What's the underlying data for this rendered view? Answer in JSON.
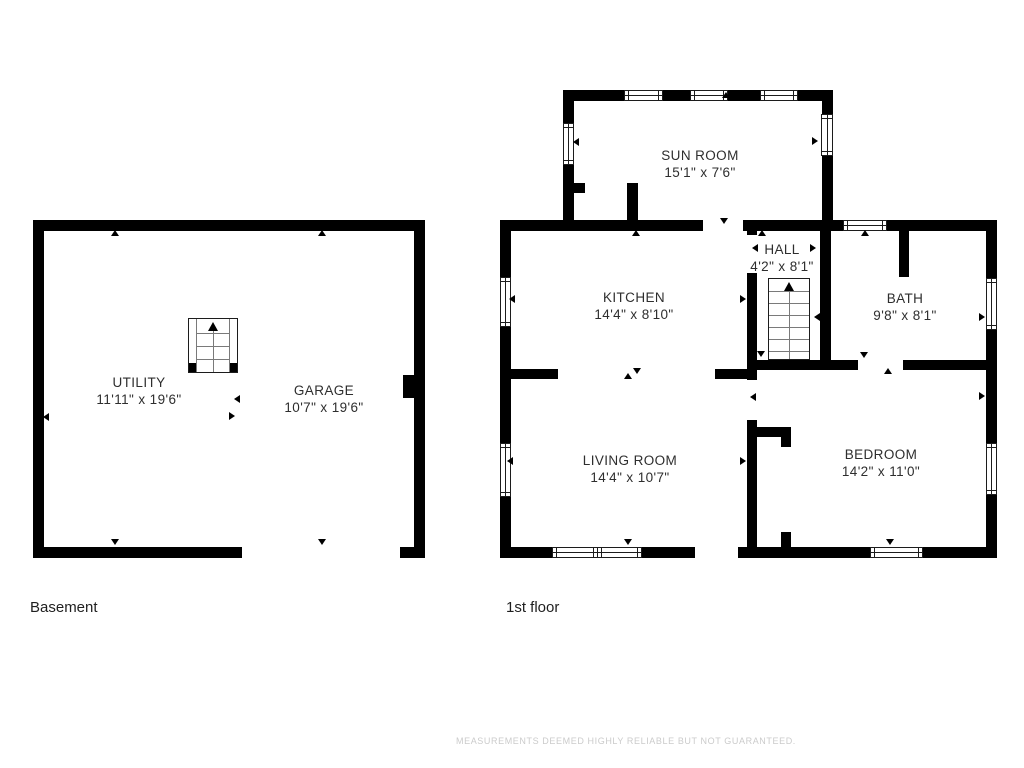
{
  "page": {
    "footer": "MEASUREMENTS DEEMED HIGHLY RELIABLE BUT NOT GUARANTEED."
  },
  "colors": {
    "wall": "#000000",
    "text": "#2e2e2e"
  },
  "floors": [
    {
      "id": "basement",
      "caption": "Basement",
      "caption_pos": {
        "x": 30,
        "y": 599
      },
      "rooms": [
        {
          "name": "UTILITY",
          "dims": "11'11\" x 19'6\"",
          "cx": 139,
          "cy": 374
        },
        {
          "name": "GARAGE",
          "dims": "10'7\" x 19'6\"",
          "cx": 324,
          "cy": 382
        }
      ]
    },
    {
      "id": "first-floor",
      "caption": "1st floor",
      "caption_pos": {
        "x": 506,
        "y": 599
      },
      "rooms": [
        {
          "name": "SUN ROOM",
          "dims": "15'1\" x 7'6\"",
          "cx": 700,
          "cy": 147
        },
        {
          "name": "KITCHEN",
          "dims": "14'4\" x 8'10\"",
          "cx": 634,
          "cy": 289
        },
        {
          "name": "HALL",
          "dims": "4'2\" x 8'1\"",
          "cx": 782,
          "cy": 241
        },
        {
          "name": "BATH",
          "dims": "9'8\" x 8'1\"",
          "cx": 905,
          "cy": 290
        },
        {
          "name": "LIVING ROOM",
          "dims": "14'4\" x 10'7\"",
          "cx": 630,
          "cy": 452
        },
        {
          "name": "BEDROOM",
          "dims": "14'2\" x 11'0\"",
          "cx": 881,
          "cy": 446
        }
      ]
    }
  ],
  "geometry": {
    "walls": [
      {
        "x": 33,
        "y": 220,
        "w": 392,
        "h": 11
      },
      {
        "x": 33,
        "y": 220,
        "w": 11,
        "h": 338
      },
      {
        "x": 414,
        "y": 220,
        "w": 11,
        "h": 338
      },
      {
        "x": 33,
        "y": 547,
        "w": 392,
        "h": 11
      },
      {
        "x": 500,
        "y": 220,
        "w": 497,
        "h": 11
      },
      {
        "x": 500,
        "y": 220,
        "w": 11,
        "h": 338
      },
      {
        "x": 986,
        "y": 220,
        "w": 11,
        "h": 338
      },
      {
        "x": 500,
        "y": 547,
        "w": 497,
        "h": 11
      },
      {
        "x": 563,
        "y": 90,
        "w": 270,
        "h": 11
      },
      {
        "x": 563,
        "y": 90,
        "w": 11,
        "h": 141
      },
      {
        "x": 822,
        "y": 90,
        "w": 11,
        "h": 141
      },
      {
        "x": 563,
        "y": 183,
        "w": 75,
        "h": 10
      },
      {
        "x": 627,
        "y": 183,
        "w": 11,
        "h": 48
      },
      {
        "x": 747,
        "y": 220,
        "w": 10,
        "h": 148
      },
      {
        "x": 820,
        "y": 220,
        "w": 11,
        "h": 150
      },
      {
        "x": 899,
        "y": 220,
        "w": 10,
        "h": 57
      },
      {
        "x": 747,
        "y": 360,
        "w": 250,
        "h": 10
      },
      {
        "x": 511,
        "y": 369,
        "w": 47,
        "h": 10
      },
      {
        "x": 715,
        "y": 369,
        "w": 38,
        "h": 10
      },
      {
        "x": 747,
        "y": 370,
        "w": 10,
        "h": 177
      },
      {
        "x": 752,
        "y": 427,
        "w": 39,
        "h": 10
      },
      {
        "x": 781,
        "y": 427,
        "w": 10,
        "h": 120
      }
    ],
    "gaps": [
      {
        "x": 242,
        "y": 547,
        "w": 158,
        "h": 11
      },
      {
        "x": 695,
        "y": 547,
        "w": 43,
        "h": 11
      },
      {
        "x": 703,
        "y": 220,
        "w": 40,
        "h": 11
      },
      {
        "x": 585,
        "y": 183,
        "w": 42,
        "h": 10
      },
      {
        "x": 747,
        "y": 235,
        "w": 10,
        "h": 38
      },
      {
        "x": 747,
        "y": 380,
        "w": 10,
        "h": 40
      },
      {
        "x": 858,
        "y": 360,
        "w": 45,
        "h": 10
      },
      {
        "x": 781,
        "y": 447,
        "w": 10,
        "h": 85
      }
    ],
    "blocks": [
      {
        "x": 403,
        "y": 375,
        "w": 14,
        "h": 23
      }
    ],
    "windows": [
      {
        "x": 624,
        "y": 90,
        "w": 39,
        "h": 11,
        "o": "h"
      },
      {
        "x": 690,
        "y": 90,
        "w": 38,
        "h": 11,
        "o": "h"
      },
      {
        "x": 760,
        "y": 90,
        "w": 38,
        "h": 11,
        "o": "h"
      },
      {
        "x": 843,
        "y": 220,
        "w": 44,
        "h": 11,
        "o": "h"
      },
      {
        "x": 552,
        "y": 547,
        "w": 46,
        "h": 11,
        "o": "h"
      },
      {
        "x": 597,
        "y": 547,
        "w": 45,
        "h": 11,
        "o": "h"
      },
      {
        "x": 870,
        "y": 547,
        "w": 53,
        "h": 11,
        "o": "h"
      },
      {
        "x": 563,
        "y": 123,
        "w": 11,
        "h": 42,
        "o": "v"
      },
      {
        "x": 821,
        "y": 114,
        "w": 12,
        "h": 42,
        "o": "v"
      },
      {
        "x": 500,
        "y": 277,
        "w": 11,
        "h": 50,
        "o": "v"
      },
      {
        "x": 500,
        "y": 443,
        "w": 11,
        "h": 54,
        "o": "v"
      },
      {
        "x": 986,
        "y": 278,
        "w": 11,
        "h": 52,
        "o": "v"
      },
      {
        "x": 986,
        "y": 443,
        "w": 11,
        "h": 52,
        "o": "v"
      }
    ],
    "stairs": [
      {
        "x": 188,
        "y": 318,
        "w": 50,
        "h": 55,
        "rails": true,
        "treads": [
          14,
          27,
          40
        ]
      },
      {
        "x": 768,
        "y": 278,
        "w": 42,
        "h": 82,
        "rails": false,
        "treads": [
          12,
          24,
          36,
          48,
          60,
          72
        ]
      }
    ],
    "ticks": [
      {
        "x": 115,
        "y": 234,
        "d": "up"
      },
      {
        "x": 322,
        "y": 234,
        "d": "up"
      },
      {
        "x": 115,
        "y": 543,
        "d": "down"
      },
      {
        "x": 322,
        "y": 543,
        "d": "down"
      },
      {
        "x": 47,
        "y": 417,
        "d": "left"
      },
      {
        "x": 238,
        "y": 399,
        "d": "left"
      },
      {
        "x": 233,
        "y": 416,
        "d": "right"
      },
      {
        "x": 636,
        "y": 234,
        "d": "up"
      },
      {
        "x": 724,
        "y": 222,
        "d": "down"
      },
      {
        "x": 762,
        "y": 234,
        "d": "up"
      },
      {
        "x": 761,
        "y": 355,
        "d": "down"
      },
      {
        "x": 756,
        "y": 248,
        "d": "left"
      },
      {
        "x": 814,
        "y": 248,
        "d": "right"
      },
      {
        "x": 577,
        "y": 142,
        "d": "left"
      },
      {
        "x": 816,
        "y": 141,
        "d": "right"
      },
      {
        "x": 726,
        "y": 96,
        "d": "up"
      },
      {
        "x": 865,
        "y": 234,
        "d": "up"
      },
      {
        "x": 864,
        "y": 356,
        "d": "down"
      },
      {
        "x": 818,
        "y": 317,
        "d": "left"
      },
      {
        "x": 983,
        "y": 317,
        "d": "right"
      },
      {
        "x": 513,
        "y": 299,
        "d": "left"
      },
      {
        "x": 744,
        "y": 299,
        "d": "right"
      },
      {
        "x": 511,
        "y": 461,
        "d": "left"
      },
      {
        "x": 744,
        "y": 461,
        "d": "right"
      },
      {
        "x": 754,
        "y": 397,
        "d": "left"
      },
      {
        "x": 888,
        "y": 372,
        "d": "up"
      },
      {
        "x": 628,
        "y": 543,
        "d": "down"
      },
      {
        "x": 890,
        "y": 543,
        "d": "down"
      },
      {
        "x": 983,
        "y": 396,
        "d": "right"
      },
      {
        "x": 628,
        "y": 377,
        "d": "up"
      },
      {
        "x": 637,
        "y": 372,
        "d": "down"
      }
    ]
  }
}
